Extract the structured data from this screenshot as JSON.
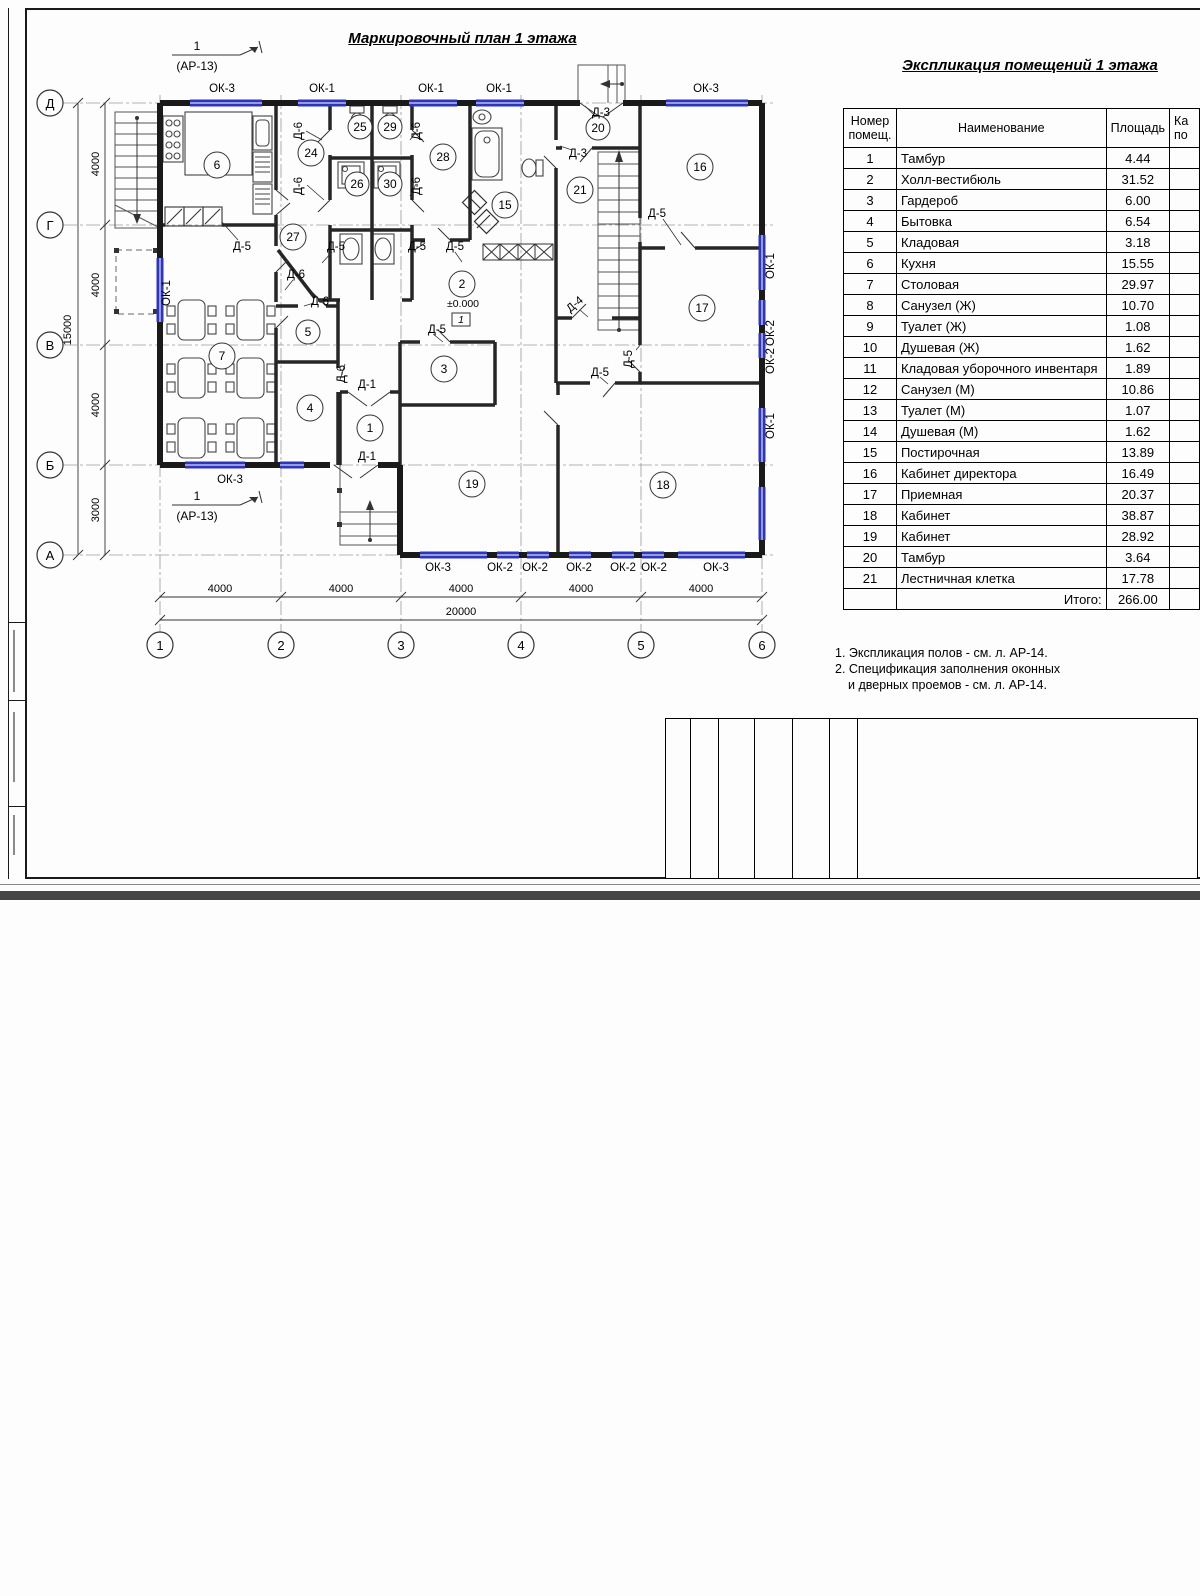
{
  "sheet": {
    "plan_title": "Маркировочный план 1 этажа",
    "section_marker": {
      "num": "1",
      "ref": "(АР-13)"
    },
    "axes_letters": [
      "Д",
      "Г",
      "В",
      "Б",
      "А"
    ],
    "axes_numbers": [
      "1",
      "2",
      "3",
      "4",
      "5",
      "6"
    ],
    "dims": {
      "left": [
        "4000",
        "4000",
        "4000",
        "3000"
      ],
      "left_total": "15000",
      "bottom": [
        "4000",
        "4000",
        "4000",
        "4000",
        "4000"
      ],
      "bottom_total": "20000"
    },
    "level_mark": "±0.000",
    "floor_type": "1",
    "windows": {
      "ok1": "ОК-1",
      "ok2": "ОК-2",
      "ok3": "ОК-3"
    },
    "doors": {
      "d1": "Д-1",
      "d3": "Д-3",
      "d4": "Д-4",
      "d5": "Д-5",
      "d6": "Д-6"
    },
    "bubbles": {
      "r1": "1",
      "r2": "2",
      "r3": "3",
      "r4": "4",
      "r5": "5",
      "r6": "6",
      "r7": "7",
      "r15": "15",
      "r16": "16",
      "r17": "17",
      "r18": "18",
      "r19": "19",
      "r20": "20",
      "r21": "21",
      "r24": "24",
      "r25": "25",
      "r26": "26",
      "r27": "27",
      "r28": "28",
      "r29": "29",
      "r30": "30"
    }
  },
  "explication": {
    "title": "Экспликация помещений 1 этажа",
    "col_num_line1": "Номер",
    "col_num_line2": "помещ.",
    "col_name": "Наименование",
    "col_area": "Площадь",
    "col_cat_line1": "Ка",
    "col_cat_line2": "по",
    "rows": [
      {
        "num": "1",
        "name": "Тамбур",
        "area": "4.44"
      },
      {
        "num": "2",
        "name": "Холл-вестибюль",
        "area": "31.52"
      },
      {
        "num": "3",
        "name": "Гардероб",
        "area": "6.00"
      },
      {
        "num": "4",
        "name": "Бытовка",
        "area": "6.54"
      },
      {
        "num": "5",
        "name": "Кладовая",
        "area": "3.18"
      },
      {
        "num": "6",
        "name": "Кухня",
        "area": "15.55"
      },
      {
        "num": "7",
        "name": "Столовая",
        "area": "29.97"
      },
      {
        "num": "8",
        "name": "Санузел (Ж)",
        "area": "10.70"
      },
      {
        "num": "9",
        "name": "Туалет (Ж)",
        "area": "1.08"
      },
      {
        "num": "10",
        "name": "Душевая (Ж)",
        "area": "1.62"
      },
      {
        "num": "11",
        "name": "Кладовая уборочного инвентаря",
        "area": "1.89"
      },
      {
        "num": "12",
        "name": "Санузел (М)",
        "area": "10.86"
      },
      {
        "num": "13",
        "name": "Туалет (М)",
        "area": "1.07"
      },
      {
        "num": "14",
        "name": "Душевая (М)",
        "area": "1.62"
      },
      {
        "num": "15",
        "name": "Постирочная",
        "area": "13.89"
      },
      {
        "num": "16",
        "name": "Кабинет директора",
        "area": "16.49"
      },
      {
        "num": "17",
        "name": "Приемная",
        "area": "20.37"
      },
      {
        "num": "18",
        "name": "Кабинет",
        "area": "38.87"
      },
      {
        "num": "19",
        "name": "Кабинет",
        "area": "28.92"
      },
      {
        "num": "20",
        "name": "Тамбур",
        "area": "3.64"
      },
      {
        "num": "21",
        "name": "Лестничная клетка",
        "area": "17.78"
      }
    ],
    "total_label": "Итого:",
    "total_value": "266.00"
  },
  "notes": {
    "line1": "1. Экспликация полов - см. л. АР-14.",
    "line2": "2. Спецификация заполнения оконных",
    "line3": "и дверных проемов - см. л. АР-14."
  },
  "titleblock": {
    "doc_code": "02Э-17-АР",
    "object_line1": "Общежитие на 23 человека по адресу:",
    "object_line2": "Республика Коми, г. Усинск",
    "header_cells": [
      "Изм.",
      "Кол.",
      "Лист",
      "№док.",
      "Подпись",
      "Дата"
    ],
    "roles": [
      "Разработал",
      "Н. контр.",
      "ГИП"
    ],
    "org1": "ООО \"Феррум\"",
    "stage_label": "Стадия",
    "sheet_label": "Лист",
    "sheets_label": "Листов",
    "stage": "ЭП",
    "sheet": "8",
    "sheets": "14",
    "drawing_title": "Маркировочный план 1 этажа.",
    "org2": "ООО \"Альянс\""
  }
}
